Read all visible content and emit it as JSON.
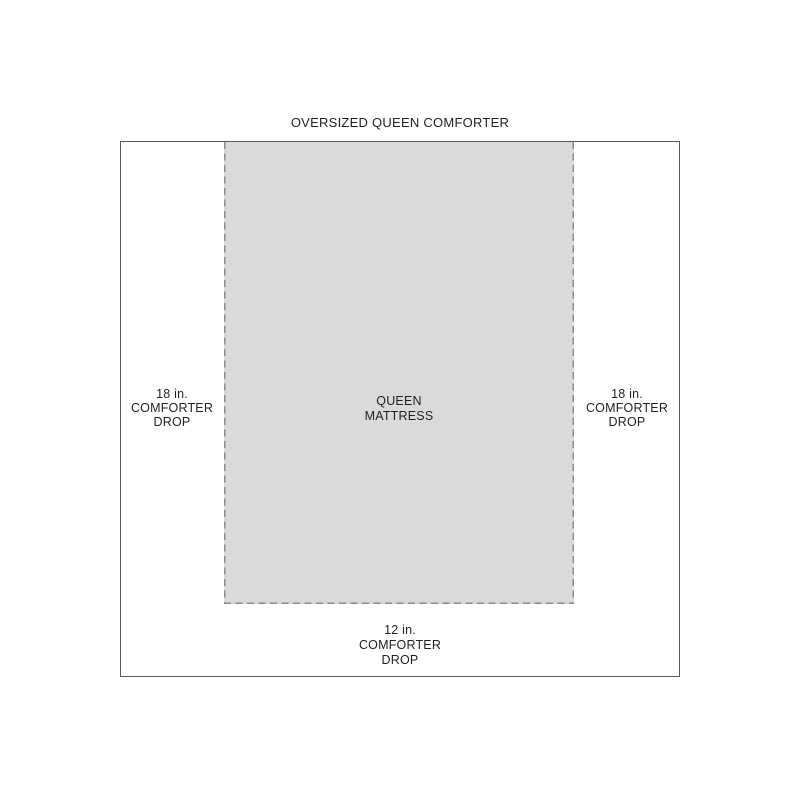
{
  "title": "OVERSIZED QUEEN COMFORTER",
  "mattress": {
    "label_line1": "QUEEN",
    "label_line2": "MATTRESS"
  },
  "drops": {
    "left": {
      "amount": "18 in.",
      "line2": "COMFORTER",
      "line3": "DROP"
    },
    "right": {
      "amount": "18 in.",
      "line2": "COMFORTER",
      "line3": "DROP"
    },
    "bottom": {
      "amount": "12 in.",
      "line2": "COMFORTER",
      "line3": "DROP"
    }
  },
  "colors": {
    "background": "#ffffff",
    "outline": "#58595b",
    "dash": "#8a8c8e",
    "text": "#231f20",
    "mattress_fill": "#d9dad9"
  }
}
